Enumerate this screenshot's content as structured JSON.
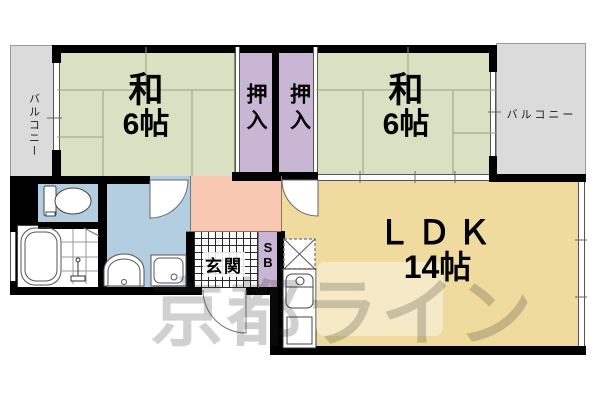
{
  "rooms": {
    "balcony_left": {
      "label": "バルコニー"
    },
    "washitsu_left": {
      "name": "和",
      "size": "6帖"
    },
    "closet_left": {
      "label": "押入"
    },
    "closet_right": {
      "label": "押入"
    },
    "washitsu_right": {
      "name": "和",
      "size": "6帖"
    },
    "balcony_right": {
      "label": "バルコニー"
    },
    "hall": {
      "label": ""
    },
    "genkan": {
      "label": "玄関"
    },
    "shoebox": {
      "line1": "S",
      "line2": "B"
    },
    "ldk": {
      "name": "ＬＤＫ",
      "size": "14帖"
    }
  },
  "fixtures": [
    "toilet",
    "bathtub",
    "shower",
    "washbasin",
    "washing-machine",
    "kitchen-sink",
    "stove",
    "refrigerator-space"
  ],
  "watermark": {
    "text": "京都ライン"
  },
  "colors": {
    "tatami": "#d9e1c2",
    "closet": "#c9b6d4",
    "balcony": "#dbdbdb",
    "ldk": "#efdb9e",
    "hall": "#f8c8b2",
    "wet": "#b3cde1",
    "wall": "#000000",
    "tatami_line": "#97a183",
    "watermark": "rgba(40,40,40,0.22)"
  }
}
